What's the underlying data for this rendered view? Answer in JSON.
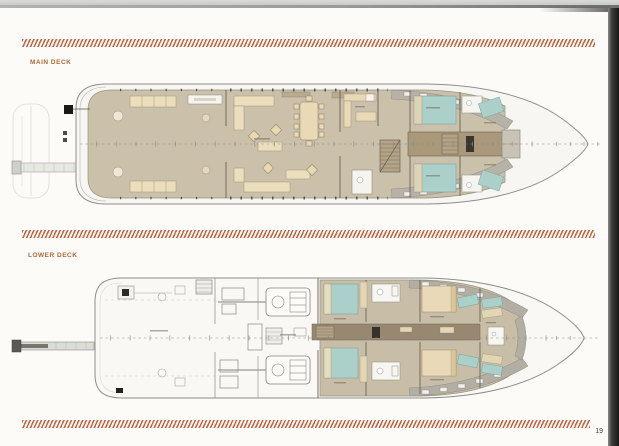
{
  "page": {
    "number": "19"
  },
  "sections": {
    "main_deck": {
      "label": "MAIN DECK",
      "description": "yacht main deck floor plan"
    },
    "lower_deck": {
      "label": "LOWER DECK",
      "description": "yacht lower deck floor plan"
    }
  },
  "colors": {
    "hatch_orange": "#c2552f",
    "label_orange": "#ad6a36",
    "deck_tan": "#cbc1ab",
    "furniture_cream": "#ead9b6",
    "bed_teal": "#abd0ca",
    "corridor_brown": "#998871",
    "side_deck_gray": "#b5b0a4",
    "outline_gray": "#8e8e88",
    "page_background": "#fcfbf8"
  }
}
